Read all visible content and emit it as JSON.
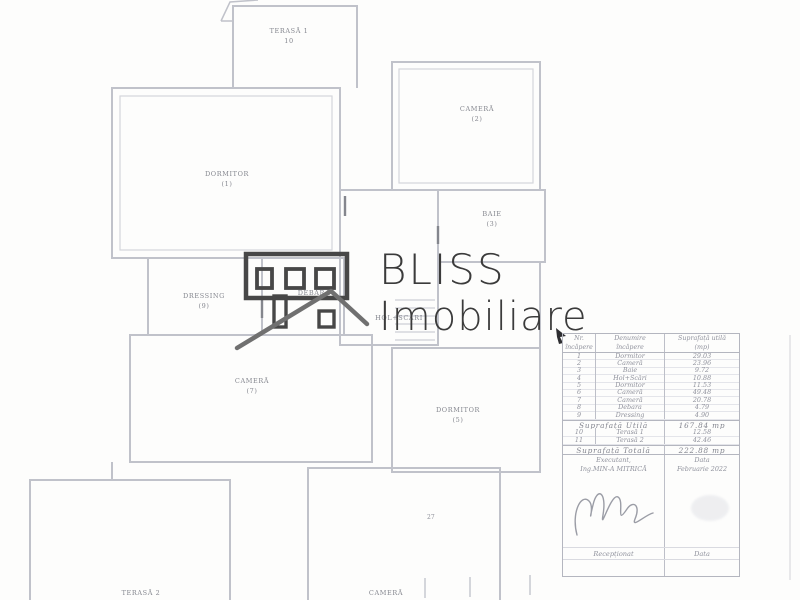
{
  "logo": {
    "line1": "BLISS",
    "line2": "Imobiliare",
    "icon": "house-icon",
    "color": "#3b3b3b"
  },
  "floorplan": {
    "rooms": [
      {
        "name": "TERASĂ 1",
        "number": "10"
      },
      {
        "name": "CAMERĂ",
        "number": "(2)"
      },
      {
        "name": "DORMITOR",
        "number": "(1)"
      },
      {
        "name": "BAIE",
        "number": "(3)"
      },
      {
        "name": "DRESSING",
        "number": "(9)"
      },
      {
        "name": "DEBARA",
        "number": ""
      },
      {
        "name": "HOL+SCĂRI",
        "number": ""
      },
      {
        "name": "CAMERĂ",
        "number": "(7)"
      },
      {
        "name": "DORMITOR",
        "number": "(5)"
      },
      {
        "name": "TERASĂ 2",
        "number": ""
      },
      {
        "name": "CAMERĂ",
        "number": ""
      }
    ],
    "dimension_label": "27"
  },
  "table": {
    "headers": {
      "col1_line1": "Nr.",
      "col1_line2": "încăpere",
      "col2_line1": "Denumire",
      "col2_line2": "încăpere",
      "col3_line1": "Suprafață utilă",
      "col3_line2": "(mp)"
    },
    "rows": [
      {
        "nr": "1",
        "name": "Dormitor",
        "area": "29.03"
      },
      {
        "nr": "2",
        "name": "Cameră",
        "area": "23.96"
      },
      {
        "nr": "3",
        "name": "Baie",
        "area": "9.72"
      },
      {
        "nr": "4",
        "name": "Hol+Scări",
        "area": "10.88"
      },
      {
        "nr": "5",
        "name": "Dormitor",
        "area": "11.53"
      },
      {
        "nr": "6",
        "name": "Cameră",
        "area": "49.48"
      },
      {
        "nr": "7",
        "name": "Cameră",
        "area": "20.78"
      },
      {
        "nr": "8",
        "name": "Debara",
        "area": "4.79"
      },
      {
        "nr": "9",
        "name": "Dressing",
        "area": "4.90"
      }
    ],
    "suprafata_utila": {
      "label": "Suprafață Utilă",
      "value": "167.84 mp"
    },
    "terase": [
      {
        "nr": "10",
        "name": "Terasă 1",
        "area": "12.58"
      },
      {
        "nr": "11",
        "name": "Terasă 2",
        "area": "42.46"
      }
    ],
    "suprafata_totala": {
      "label": "Suprafață Totală",
      "value": "222.88 mp"
    },
    "executant": {
      "label": "Executant,",
      "name": "Ing.MIN-A MITRICĂ",
      "date_label": "Data",
      "date_value": "Februarie 2022"
    },
    "reception": {
      "left": "Recepționat",
      "right": "Data"
    }
  },
  "colors": {
    "logo_text": "#3b3b3b",
    "plan_lines": "#c0c2ca",
    "plan_text": "#85878f",
    "table_text": "#8f919c"
  }
}
